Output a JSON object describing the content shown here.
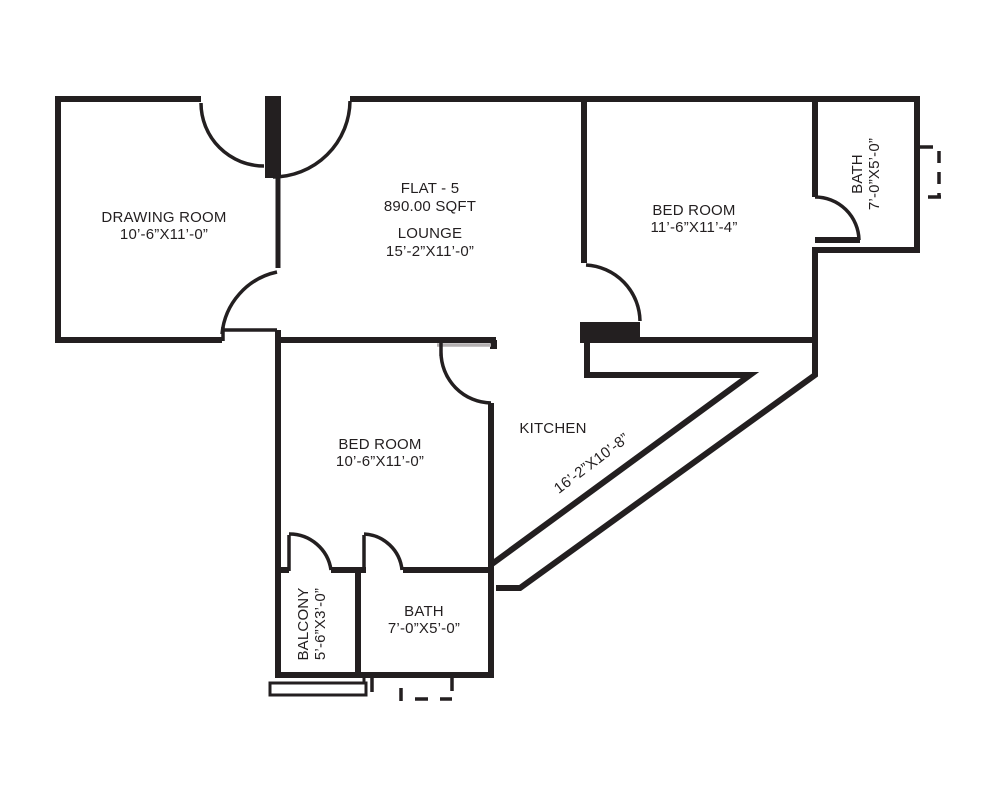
{
  "plan": {
    "flat": {
      "title": "FLAT - 5",
      "area": "890.00 SQFT"
    },
    "rooms": {
      "drawing_room": {
        "name": "DRAWING ROOM",
        "dims": "10’-6”X11’-0”"
      },
      "lounge": {
        "name": "LOUNGE",
        "dims": "15’-2”X11’-0”"
      },
      "bedroom_top": {
        "name": "BED ROOM",
        "dims": "11’-6”X11’-4”"
      },
      "bath_top": {
        "name": "BATH",
        "dims": "7’-0”X5’-0”"
      },
      "kitchen": {
        "name": "KITCHEN",
        "dims": "16’-2”X10’-8”"
      },
      "bedroom_mid": {
        "name": "BED ROOM",
        "dims": "10’-6”X11’-0”"
      },
      "balcony": {
        "name": "BALCONY",
        "dims": "5’-6”X3’-0”"
      },
      "bath_bottom": {
        "name": "BATH",
        "dims": "7’-0”X5’-0”"
      }
    },
    "colors": {
      "wall": "#231f20",
      "lintel": "#b3afb0",
      "background": "#ffffff"
    }
  }
}
